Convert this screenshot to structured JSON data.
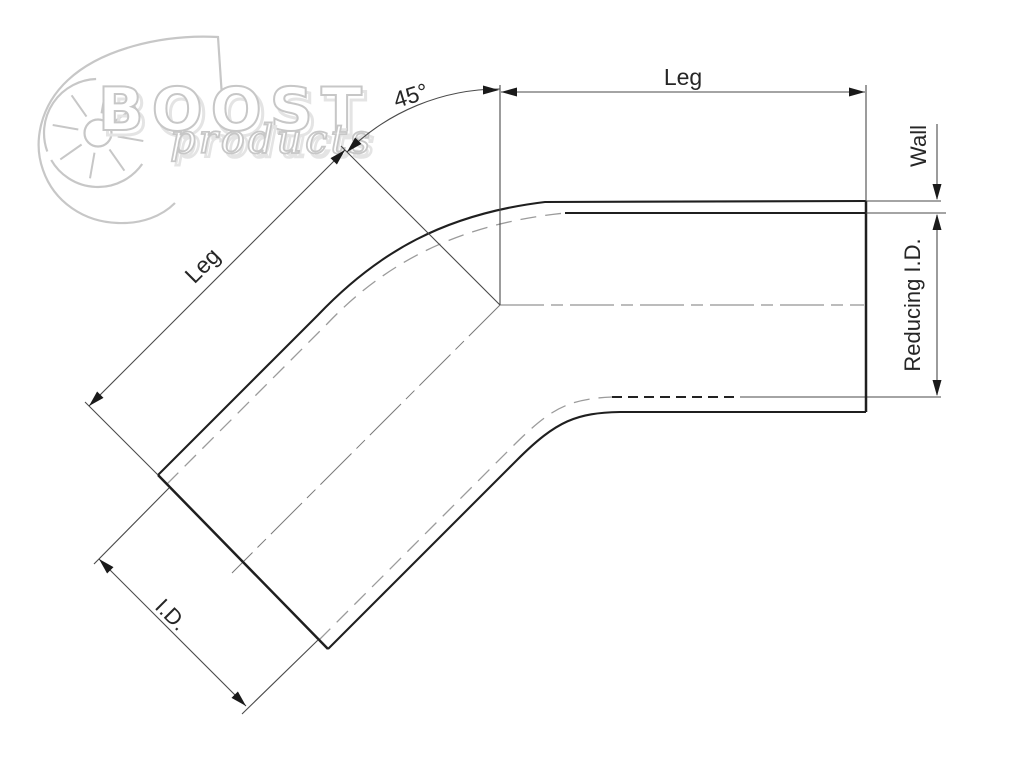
{
  "drawing": {
    "angle_label": "45°",
    "top_leg_label": "Leg",
    "left_leg_label": "Leg",
    "wall_label": "Wall",
    "reducing_id_label": "Reducing I.D.",
    "id_label": "I.D."
  },
  "watermark": {
    "brand": "BOOST",
    "script": "products"
  },
  "colors": {
    "solid_line": "#1f1f1f",
    "thin_line": "#4a4a4a",
    "hidden_line": "#9b9b9b",
    "centerline": "#7a7a7a",
    "watermark_gray": "#c7c7c7",
    "watermark_shadow": "#e4e4e4",
    "background": "#ffffff"
  }
}
